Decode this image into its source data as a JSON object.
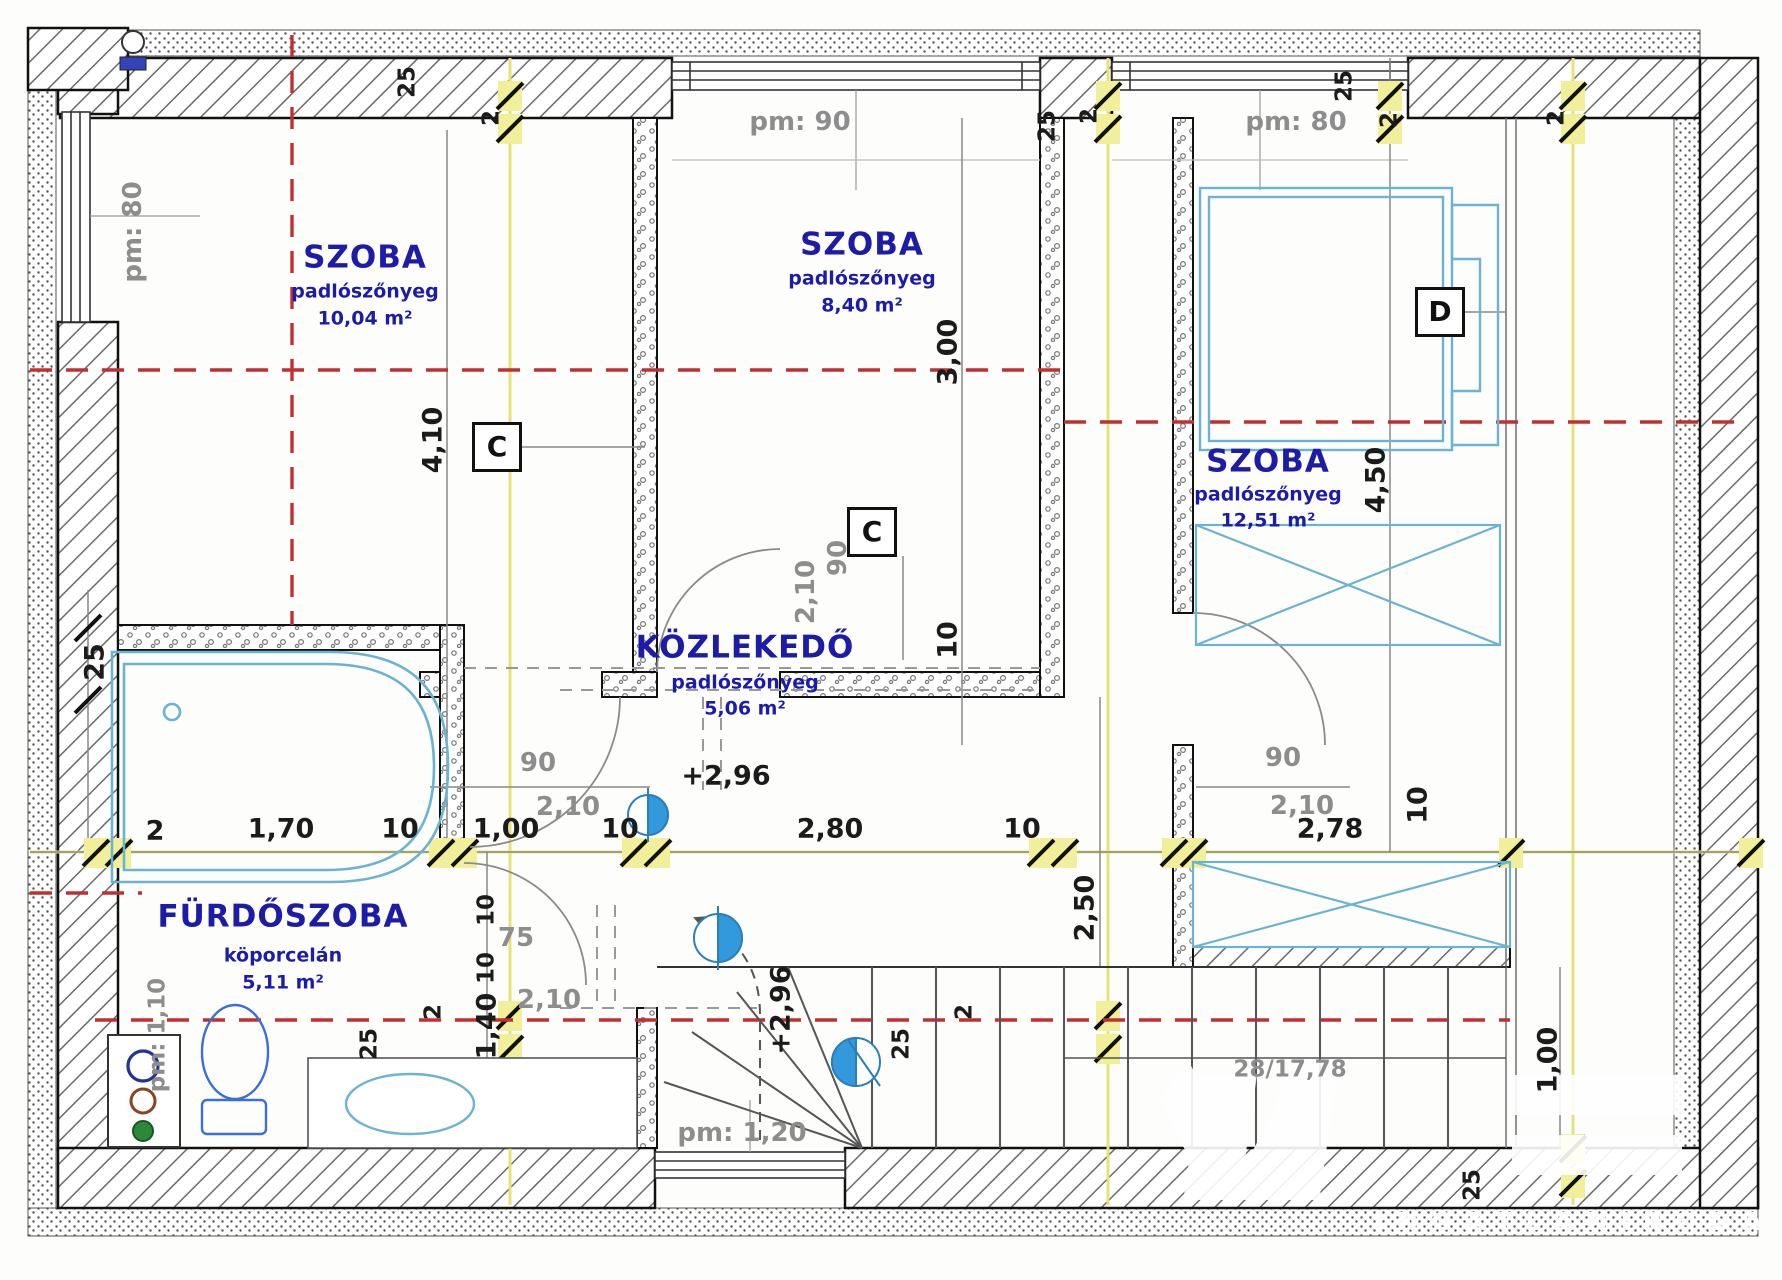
{
  "document": {
    "type": "floor-plan",
    "language": "hu"
  },
  "colors": {
    "grid_yellow": "#e6e27b",
    "roof_line_red": "#c03030",
    "furniture_cyan": "#6ab4d2",
    "room_label_navy": "#1c1ca8",
    "dim_text_black": "#1b1b1b",
    "annotation_gray": "#8d8d8d",
    "marker_blue": "#3399dd"
  },
  "watermark": {
    "subtitle": "INGATLANIRODA"
  },
  "labels": [
    {
      "name": "room-szoba1-title",
      "text": "SZOBA",
      "x": 365,
      "y": 258,
      "cls": "title"
    },
    {
      "name": "room-szoba1-floor",
      "text": "padlószőnyeg",
      "x": 365,
      "y": 292,
      "cls": "sub"
    },
    {
      "name": "room-szoba1-area",
      "text": "10,04 m²",
      "x": 365,
      "y": 319,
      "cls": "sub"
    },
    {
      "name": "room-szoba2-title",
      "text": "SZOBA",
      "x": 862,
      "y": 245,
      "cls": "title"
    },
    {
      "name": "room-szoba2-floor",
      "text": "padlószőnyeg",
      "x": 862,
      "y": 279,
      "cls": "sub"
    },
    {
      "name": "room-szoba2-area",
      "text": "8,40 m²",
      "x": 862,
      "y": 306,
      "cls": "sub"
    },
    {
      "name": "room-szoba3-title",
      "text": "SZOBA",
      "x": 1268,
      "y": 462,
      "cls": "title"
    },
    {
      "name": "room-szoba3-floor",
      "text": "padlószőnyeg",
      "x": 1268,
      "y": 495,
      "cls": "sub"
    },
    {
      "name": "room-szoba3-area",
      "text": "12,51 m²",
      "x": 1268,
      "y": 521,
      "cls": "sub"
    },
    {
      "name": "room-kozlekedo-title",
      "text": "KÖZLEKEDŐ",
      "x": 745,
      "y": 648,
      "cls": "title"
    },
    {
      "name": "room-kozlekedo-floor",
      "text": "padlószőnyeg",
      "x": 745,
      "y": 683,
      "cls": "sub"
    },
    {
      "name": "room-kozlekedo-area",
      "text": "5,06 m²",
      "x": 745,
      "y": 709,
      "cls": "sub"
    },
    {
      "name": "room-furdoszoba-title",
      "text": "FÜRDŐSZOBA",
      "x": 283,
      "y": 917,
      "cls": "title"
    },
    {
      "name": "room-furdoszoba-floor",
      "text": "köporcelán",
      "x": 283,
      "y": 956,
      "cls": "sub"
    },
    {
      "name": "room-furdoszoba-area",
      "text": "5,11 m²",
      "x": 283,
      "y": 983,
      "cls": "sub"
    },
    {
      "name": "window-parapet-left",
      "text": "pm: 80",
      "x": 133,
      "y": 232,
      "cls": "gray",
      "rot": 1
    },
    {
      "name": "window-parapet-top-mid",
      "text": "pm: 90",
      "x": 800,
      "y": 122,
      "cls": "gray"
    },
    {
      "name": "window-parapet-top-right",
      "text": "pm: 80",
      "x": 1296,
      "y": 122,
      "cls": "gray"
    },
    {
      "name": "window-parapet-bottom",
      "text": "pm: 1,20",
      "x": 742,
      "y": 1133,
      "cls": "gray"
    },
    {
      "name": "window-parapet-bath",
      "text": "pm: 1,10",
      "x": 158,
      "y": 1035,
      "cls": "graysm",
      "rot": 1
    },
    {
      "name": "door-left-width",
      "text": "90",
      "x": 538,
      "y": 763,
      "cls": "gray"
    },
    {
      "name": "door-left-height",
      "text": "2,10",
      "x": 568,
      "y": 807,
      "cls": "gray"
    },
    {
      "name": "door-mid-width",
      "text": "90",
      "x": 838,
      "y": 558,
      "cls": "gray",
      "rot": 1
    },
    {
      "name": "door-mid-height",
      "text": "2,10",
      "x": 806,
      "y": 592,
      "cls": "gray",
      "rot": 1
    },
    {
      "name": "door-right-width",
      "text": "90",
      "x": 1283,
      "y": 758,
      "cls": "gray"
    },
    {
      "name": "door-right-height",
      "text": "2,10",
      "x": 1302,
      "y": 806,
      "cls": "gray"
    },
    {
      "name": "door-bath-width",
      "text": "75",
      "x": 516,
      "y": 938,
      "cls": "gray"
    },
    {
      "name": "door-bath-height",
      "text": "2,10",
      "x": 549,
      "y": 1000,
      "cls": "gray"
    },
    {
      "name": "stair-steps-label",
      "text": "28/17,78",
      "x": 1290,
      "y": 1070,
      "cls": "graysm"
    },
    {
      "name": "dim-2-chain-left",
      "text": "2",
      "x": 155,
      "y": 831,
      "cls": "dim"
    },
    {
      "name": "dim-1-70",
      "text": "1,70",
      "x": 281,
      "y": 829,
      "cls": "dim"
    },
    {
      "name": "dim-10-a",
      "text": "10",
      "x": 400,
      "y": 829,
      "cls": "dim"
    },
    {
      "name": "dim-1-00",
      "text": "1,00",
      "x": 506,
      "y": 829,
      "cls": "dim"
    },
    {
      "name": "dim-10-b",
      "text": "10",
      "x": 620,
      "y": 829,
      "cls": "dim"
    },
    {
      "name": "dim-2-80",
      "text": "2,80",
      "x": 830,
      "y": 829,
      "cls": "dim"
    },
    {
      "name": "dim-10-c",
      "text": "10",
      "x": 1022,
      "y": 829,
      "cls": "dim"
    },
    {
      "name": "dim-2-78",
      "text": "2,78",
      "x": 1330,
      "y": 829,
      "cls": "dim"
    },
    {
      "name": "dim-10-d",
      "text": "10",
      "x": 1418,
      "y": 805,
      "cls": "dim",
      "rot": 1
    },
    {
      "name": "level-mark-corridor",
      "text": "+2,96",
      "x": 726,
      "y": 776,
      "cls": "dim"
    },
    {
      "name": "level-mark-stair",
      "text": "+2,96",
      "x": 781,
      "y": 1010,
      "cls": "dim",
      "rot": 1
    },
    {
      "name": "dim-4-10",
      "text": "4,10",
      "x": 433,
      "y": 440,
      "cls": "dim",
      "rot": 1
    },
    {
      "name": "dim-3-00",
      "text": "3,00",
      "x": 948,
      "y": 352,
      "cls": "dim",
      "rot": 1
    },
    {
      "name": "dim-10-e",
      "text": "10",
      "x": 948,
      "y": 640,
      "cls": "dim",
      "rot": 1
    },
    {
      "name": "dim-4-50",
      "text": "4,50",
      "x": 1376,
      "y": 480,
      "cls": "dim",
      "rot": 1
    },
    {
      "name": "dim-2-50",
      "text": "2,50",
      "x": 1085,
      "y": 908,
      "cls": "dim",
      "rot": 1
    },
    {
      "name": "dim-1-00-right",
      "text": "1,00",
      "x": 1548,
      "y": 1060,
      "cls": "dim",
      "rot": 1
    },
    {
      "name": "dim-1-40",
      "text": "1,40",
      "x": 487,
      "y": 1026,
      "cls": "dim",
      "rot": 1
    },
    {
      "name": "dim-10-f",
      "text": "10",
      "x": 487,
      "y": 910,
      "cls": "dimsm",
      "rot": 1
    },
    {
      "name": "dim-10-g",
      "text": "10",
      "x": 487,
      "y": 968,
      "cls": "dimsm",
      "rot": 1
    },
    {
      "name": "dim-25-left",
      "text": "25",
      "x": 95,
      "y": 662,
      "cls": "dim",
      "rot": 1
    },
    {
      "name": "dim-25-top-a",
      "text": "25",
      "x": 408,
      "y": 82,
      "cls": "dimsm",
      "rot": 1
    },
    {
      "name": "dim-2-top-a",
      "text": "2",
      "x": 492,
      "y": 118,
      "cls": "dimsm",
      "rot": 1
    },
    {
      "name": "dim-25-top-b",
      "text": "25",
      "x": 1048,
      "y": 126,
      "cls": "dimsm",
      "rot": 1
    },
    {
      "name": "dim-2-top-b",
      "text": "2",
      "x": 1090,
      "y": 116,
      "cls": "dimsm",
      "rot": 1
    },
    {
      "name": "dim-25-top-c",
      "text": "25",
      "x": 1345,
      "y": 86,
      "cls": "dimsm",
      "rot": 1
    },
    {
      "name": "dim-2-top-c",
      "text": "2",
      "x": 1390,
      "y": 120,
      "cls": "dimsm",
      "rot": 1
    },
    {
      "name": "dim-2-top-d",
      "text": "2",
      "x": 1557,
      "y": 118,
      "cls": "dimsm",
      "rot": 1
    },
    {
      "name": "dim-25-bottom-a",
      "text": "25",
      "x": 370,
      "y": 1044,
      "cls": "dimsm",
      "rot": 1
    },
    {
      "name": "dim-2-bottom-a",
      "text": "2",
      "x": 434,
      "y": 1012,
      "cls": "dimsm",
      "rot": 1
    },
    {
      "name": "dim-25-bottom-b",
      "text": "25",
      "x": 902,
      "y": 1044,
      "cls": "dimsm",
      "rot": 1
    },
    {
      "name": "dim-2-bottom-b",
      "text": "2",
      "x": 965,
      "y": 1012,
      "cls": "dimsm",
      "rot": 1
    },
    {
      "name": "dim-25-bottom-right",
      "text": "25",
      "x": 1473,
      "y": 1185,
      "cls": "dimsm",
      "rot": 1
    },
    {
      "name": "section-marker-c1",
      "text": "C",
      "x": 497,
      "y": 447,
      "cls": "box"
    },
    {
      "name": "section-marker-c2",
      "text": "C",
      "x": 872,
      "y": 532,
      "cls": "box"
    },
    {
      "name": "section-marker-d",
      "text": "D",
      "x": 1440,
      "y": 312,
      "cls": "box"
    }
  ]
}
